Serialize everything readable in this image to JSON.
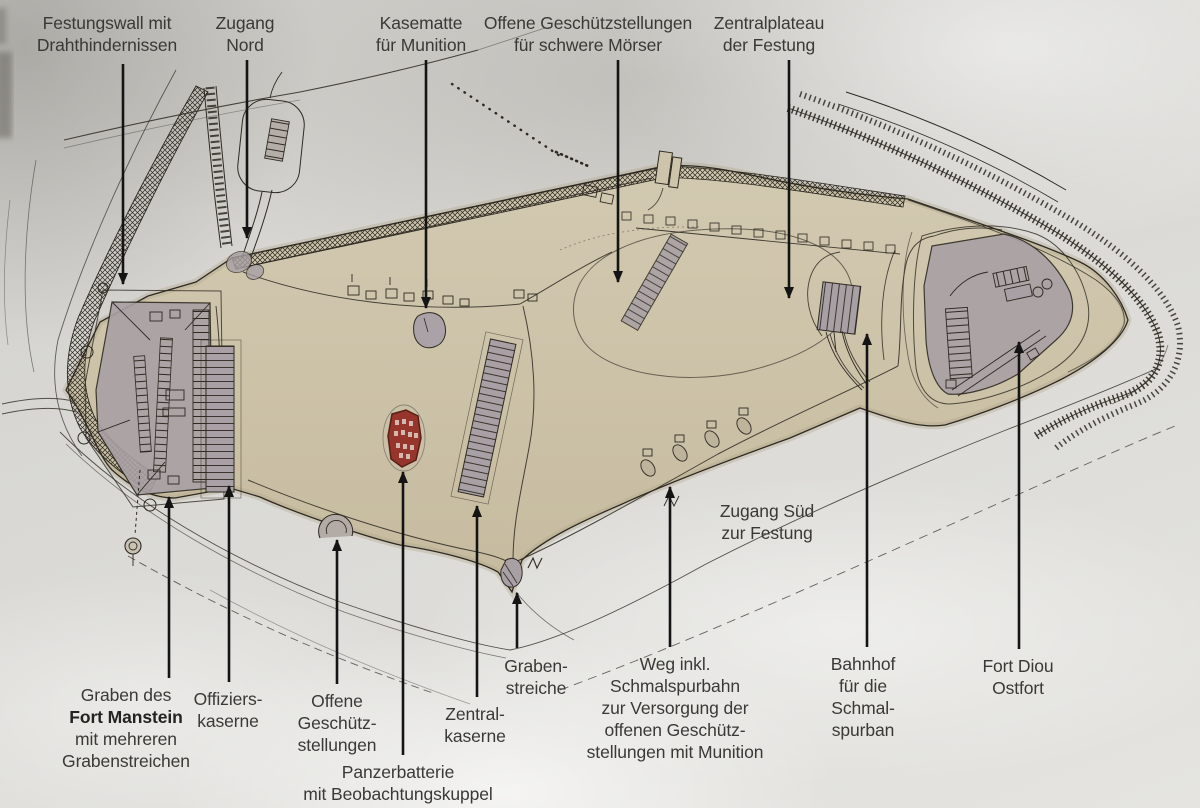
{
  "colors": {
    "paper": "#d8d7d3",
    "plateau": "#cdc4ab",
    "plateau_rim": "#b3a88c",
    "fort": "#a8a0a4",
    "red": "#96352b",
    "red_dark": "#581f17",
    "ink": "#2e2a22",
    "arrow": "#141414",
    "label": "#3a3935"
  },
  "callouts": [
    {
      "id": "festungswall",
      "x": 107,
      "y": 12,
      "lines": [
        "Festungswall mit",
        "Drahthindernissen"
      ],
      "arrow": {
        "x1": 123,
        "y1": 64,
        "x2": 123,
        "y2": 284
      }
    },
    {
      "id": "zugang-nord",
      "x": 245,
      "y": 12,
      "lines": [
        "Zugang",
        "Nord"
      ],
      "arrow": {
        "x1": 247,
        "y1": 60,
        "x2": 247,
        "y2": 238
      }
    },
    {
      "id": "kasematte-munition",
      "x": 421,
      "y": 12,
      "lines": [
        "Kasematte",
        "für Munition"
      ],
      "arrow": {
        "x1": 426,
        "y1": 60,
        "x2": 426,
        "y2": 308
      }
    },
    {
      "id": "offene-stellungen-moerser",
      "x": 588,
      "y": 12,
      "lines": [
        "Offene Geschützstellungen",
        "für schwere Mörser"
      ],
      "arrow": {
        "x1": 618,
        "y1": 60,
        "x2": 618,
        "y2": 282
      }
    },
    {
      "id": "zentralplateau",
      "x": 769,
      "y": 12,
      "lines": [
        "Zentralplateau",
        "der Festung"
      ],
      "arrow": {
        "x1": 789,
        "y1": 60,
        "x2": 789,
        "y2": 298
      }
    },
    {
      "id": "zugang-sued",
      "x": 767,
      "y": 500,
      "lines": [
        "Zugang Süd",
        "zur Festung"
      ]
    },
    {
      "id": "graben-fort-manstein",
      "x": 126,
      "y": 684,
      "lines": [
        "Graben des",
        "Fort Manstein",
        "mit mehreren",
        "Grabenstreichen"
      ],
      "bold_line": 1,
      "arrow": {
        "x1": 169,
        "y1": 678,
        "x2": 169,
        "y2": 497
      }
    },
    {
      "id": "offizierskaserne",
      "x": 228,
      "y": 688,
      "lines": [
        "Offiziers-",
        "kaserne"
      ],
      "arrow": {
        "x1": 229,
        "y1": 682,
        "x2": 229,
        "y2": 486
      }
    },
    {
      "id": "offene-geschuetzstellungen",
      "x": 337,
      "y": 690,
      "lines": [
        "Offene",
        "Geschütz-",
        "stellungen"
      ],
      "arrow": {
        "x1": 337,
        "y1": 684,
        "x2": 337,
        "y2": 540
      }
    },
    {
      "id": "panzerbatterie",
      "x": 398,
      "y": 761,
      "lines": [
        "Panzerbatterie",
        "mit Beobachtungskuppel"
      ],
      "arrow": {
        "x1": 403,
        "y1": 755,
        "x2": 403,
        "y2": 472
      }
    },
    {
      "id": "zentralkaserne",
      "x": 475,
      "y": 703,
      "lines": [
        "Zentral-",
        "kaserne"
      ],
      "arrow": {
        "x1": 477,
        "y1": 697,
        "x2": 477,
        "y2": 506
      }
    },
    {
      "id": "grabenstreiche",
      "x": 536,
      "y": 655,
      "lines": [
        "Graben-",
        "streiche"
      ],
      "arrow": {
        "x1": 517,
        "y1": 648,
        "x2": 517,
        "y2": 593
      }
    },
    {
      "id": "weg-schmalspurbahn",
      "x": 675,
      "y": 653,
      "lines": [
        "Weg inkl.",
        "Schmalspurbahn",
        "zur Versorgung der",
        "offenen Geschütz-",
        "stellungen mit Munition"
      ],
      "arrow": {
        "x1": 670,
        "y1": 647,
        "x2": 670,
        "y2": 487
      }
    },
    {
      "id": "bahnhof-schmalspurbahn",
      "x": 863,
      "y": 653,
      "lines": [
        "Bahnhof",
        "für die",
        "Schmal-",
        "spurban"
      ],
      "arrow": {
        "x1": 867,
        "y1": 647,
        "x2": 867,
        "y2": 334
      }
    },
    {
      "id": "fort-diou-ostfort",
      "x": 1018,
      "y": 655,
      "lines": [
        "Fort Diou",
        "Ostfort"
      ],
      "arrow": {
        "x1": 1019,
        "y1": 649,
        "x2": 1019,
        "y2": 342
      }
    }
  ]
}
